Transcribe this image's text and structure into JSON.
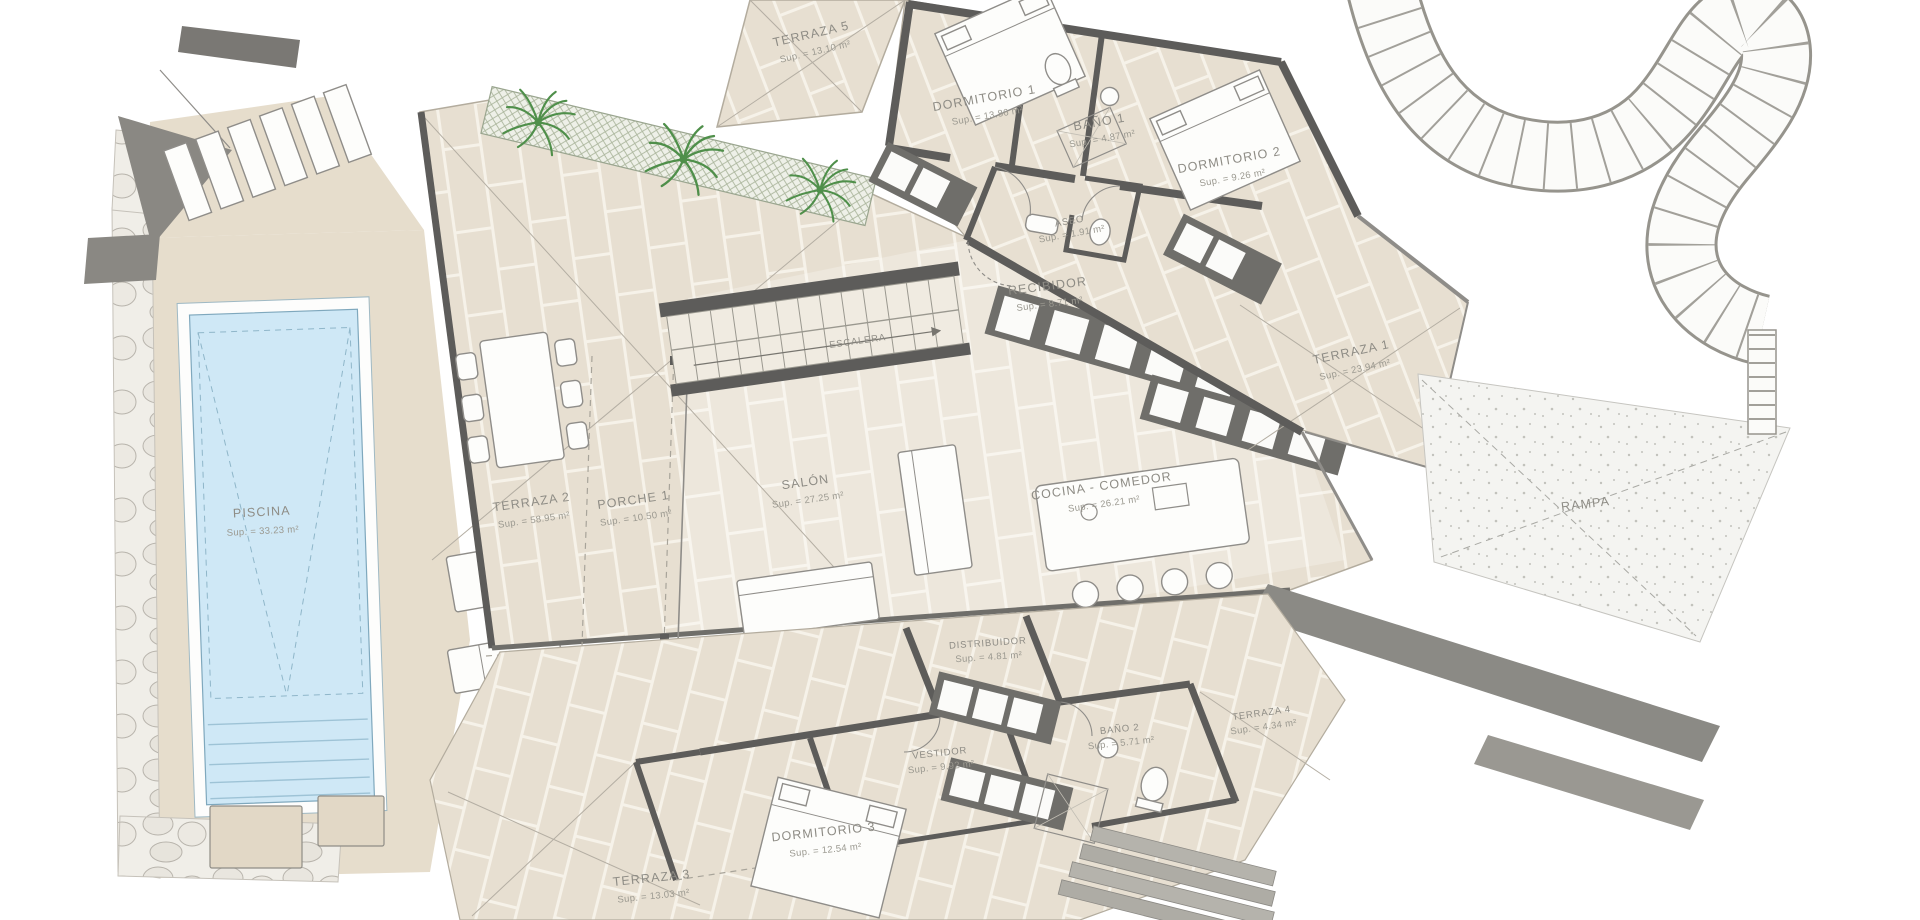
{
  "plan": {
    "type": "architectural-floor-plan",
    "colors": {
      "tile": "#e7dfd1",
      "grout": "#f6f2e9",
      "wall": "#5d5c5a",
      "pool_water": "#cfe8f6",
      "palm_green": "#4f8f4a",
      "casework_dark": "#6f6e6a",
      "label_gray": "#8e8c85"
    },
    "rooms": [
      {
        "name": "TERRAZA 5",
        "area": "Sup. = 13.10 m²"
      },
      {
        "name": "DORMITORIO 1",
        "area": "Sup. = 13.86 m²"
      },
      {
        "name": "BAÑO 1",
        "area": "Sup. = 4.87 m²"
      },
      {
        "name": "ASEO",
        "area": "Sup. = 1.91 m²"
      },
      {
        "name": "DORMITORIO 2",
        "area": "Sup. = 9.26 m²"
      },
      {
        "name": "RECIBIDOR",
        "area": "Sup. = 8.71 m²"
      },
      {
        "name": "TERRAZA 1",
        "area": "Sup. = 23.94 m²"
      },
      {
        "name": "RAMPA",
        "area": ""
      },
      {
        "name": "ESCALERA",
        "area": ""
      },
      {
        "name": "SALÓN",
        "area": "Sup. = 27.25 m²"
      },
      {
        "name": "COCINA - COMEDOR",
        "area": "Sup. = 26.21 m²"
      },
      {
        "name": "TERRAZA 2",
        "area": "Sup. = 58.95 m²"
      },
      {
        "name": "PORCHE 1",
        "area": "Sup. = 10.50 m²"
      },
      {
        "name": "PISCINA",
        "area": "Sup. = 33.23 m²"
      },
      {
        "name": "DISTRIBUIDOR",
        "area": "Sup. = 4.81 m²"
      },
      {
        "name": "VESTIDOR",
        "area": "Sup. = 9.92 m²"
      },
      {
        "name": "BAÑO 2",
        "area": "Sup. = 5.71 m²"
      },
      {
        "name": "TERRAZA 4",
        "area": "Sup. = 4.34 m²"
      },
      {
        "name": "DORMITORIO 3",
        "area": "Sup. = 12.54 m²"
      },
      {
        "name": "TERRAZA 3",
        "area": "Sup. = 13.03 m²"
      }
    ]
  }
}
